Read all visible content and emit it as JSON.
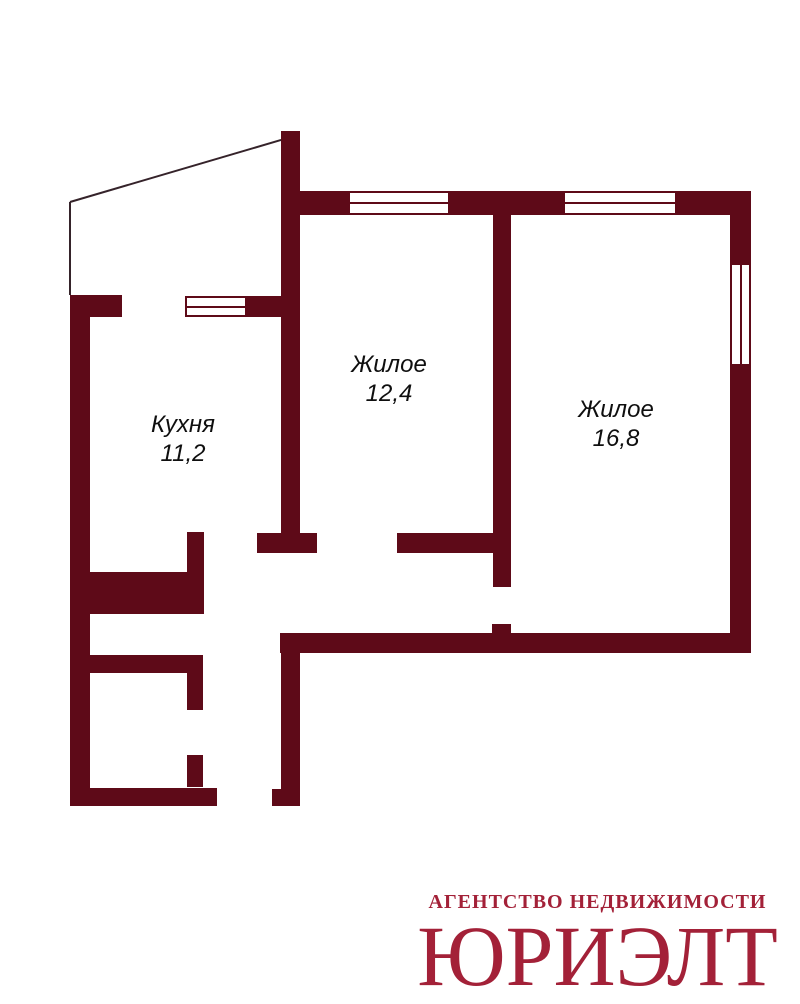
{
  "colors": {
    "background": "#ffffff",
    "wall": "#5e0a18",
    "thin_line": "#35232a",
    "label_text": "#0f0f0f",
    "logo": "#a32138"
  },
  "rooms": [
    {
      "id": "living-1",
      "name": "Жилое",
      "area": "12,4"
    },
    {
      "id": "living-2",
      "name": "Жилое",
      "area": "16,8"
    },
    {
      "id": "kitchen",
      "name": "Кухня",
      "area": "11,2"
    }
  ],
  "logo": {
    "tagline": "АГЕНТСТВО НЕДВИЖИМОСТИ",
    "brand": "ЮРИЭЛТ"
  },
  "floorplan": {
    "walls": [
      {
        "x": 281,
        "y": 131,
        "w": 19,
        "h": 402
      },
      {
        "x": 257,
        "y": 533,
        "w": 60,
        "h": 20
      },
      {
        "x": 300,
        "y": 191,
        "w": 48,
        "h": 24
      },
      {
        "x": 450,
        "y": 191,
        "w": 113,
        "h": 24
      },
      {
        "x": 677,
        "y": 191,
        "w": 53,
        "h": 24
      },
      {
        "x": 730,
        "y": 191,
        "w": 21,
        "h": 72
      },
      {
        "x": 730,
        "y": 366,
        "w": 21,
        "h": 287
      },
      {
        "x": 493,
        "y": 215,
        "w": 18,
        "h": 372
      },
      {
        "x": 492,
        "y": 624,
        "w": 19,
        "h": 9
      },
      {
        "x": 397,
        "y": 533,
        "w": 96,
        "h": 20
      },
      {
        "x": 280,
        "y": 633,
        "w": 470,
        "h": 20
      },
      {
        "x": 281,
        "y": 653,
        "w": 19,
        "h": 153
      },
      {
        "x": 272,
        "y": 789,
        "w": 28,
        "h": 17
      },
      {
        "x": 70,
        "y": 295,
        "w": 20,
        "h": 511
      },
      {
        "x": 70,
        "y": 295,
        "w": 52,
        "h": 22
      },
      {
        "x": 247,
        "y": 296,
        "w": 34,
        "h": 21
      },
      {
        "x": 88,
        "y": 572,
        "w": 116,
        "h": 42
      },
      {
        "x": 187,
        "y": 532,
        "w": 17,
        "h": 40
      },
      {
        "x": 70,
        "y": 655,
        "w": 133,
        "h": 18
      },
      {
        "x": 187,
        "y": 673,
        "w": 16,
        "h": 37
      },
      {
        "x": 187,
        "y": 755,
        "w": 16,
        "h": 32
      },
      {
        "x": 70,
        "y": 788,
        "w": 147,
        "h": 18
      }
    ],
    "windows": [
      {
        "x": 348,
        "y": 191,
        "w": 102,
        "h": 24,
        "dir": "h"
      },
      {
        "x": 563,
        "y": 191,
        "w": 114,
        "h": 24,
        "dir": "h"
      },
      {
        "x": 730,
        "y": 263,
        "w": 21,
        "h": 103,
        "dir": "v"
      },
      {
        "x": 185,
        "y": 296,
        "w": 62,
        "h": 21,
        "dir": "h"
      }
    ],
    "thin_lines": [
      {
        "x1": 70,
        "y1": 202,
        "x2": 281,
        "y2": 140
      },
      {
        "x1": 70,
        "y1": 202,
        "x2": 70,
        "y2": 295
      }
    ]
  }
}
